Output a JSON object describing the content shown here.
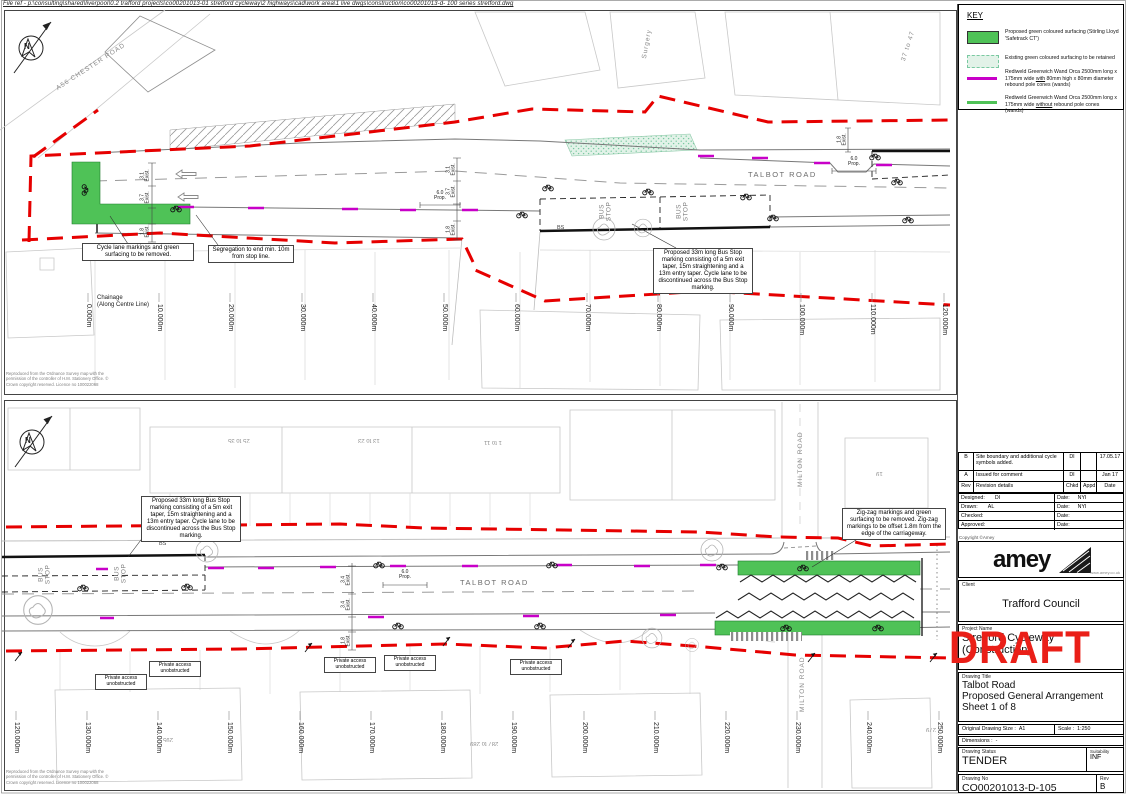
{
  "file_ref": "File ref - p:\\consulting\\shared\\liverpool\\0.2 trafford projects\\co00201013-01 stretford cycleway\\2 highways\\cad\\work area\\1 live dwgs\\construction\\co00201013-d- 100 series stretford.dwg",
  "os_copyright": "Reproduced from the Ordnance Survey map with the permission of the controller of H.M. Stationery Office. © Crown copyright reserved. Licence no 100022068",
  "north_label": "N",
  "draft_stamp": "DRAFT",
  "colors": {
    "boundary_red": "#e60000",
    "surface_green": "#4fc257",
    "wand_magenta": "#c800c8",
    "draft_red": "#ea1f18"
  },
  "key": {
    "title": "KEY",
    "item1": "Proposed green coloured surfacing (Stirling Lloyd 'Safetrack CT')",
    "item2": "Existing green coloured surfacing to be retained",
    "item3_pre": "Rediweld Greenwich Wand Orca 2500mm long x 175mm wide ",
    "item3_u": "with",
    "item3_post": " 80mm high x 80mm diameter rebound pole cones (wands)",
    "item4_pre": "Rediweld Greenwich Wand Orca 2500mm long x 175mm wide ",
    "item4_u": "without",
    "item4_post": " rebound pole cones (wands)"
  },
  "panel_top": {
    "road_label": "TALBOT ROAD",
    "side_road_label": "A56 CHESTER ROAD",
    "bus_stop_word1": "BUS",
    "bus_stop_word2": "STOP",
    "bs_label": "BS",
    "building_label_1": "37 to 47",
    "building_label_2": "Surgery",
    "ann_cycle_lane": "Cycle lane markings and green surfacing to be removed.",
    "ann_segregation": "Segregation to end min. 10m from stop line.",
    "ann_bus_stop": "Proposed 33m long Bus Stop marking consisting of a 5m exit taper, 15m straightening and a 13m entry taper. Cycle lane to be discontinued across the Bus Stop marking.",
    "chainage_title_line1": "Chainage",
    "chainage_title_line2": "(Along Centre Line)",
    "chainages": [
      "0.000m",
      "10.000m",
      "20.000m",
      "30.000m",
      "40.000m",
      "50.000m",
      "60.000m",
      "70.000m",
      "80.000m",
      "90.000m",
      "100.000m",
      "110.000m",
      "120.000m"
    ],
    "dims": [
      {
        "v": "3.1",
        "q": "Exist."
      },
      {
        "v": "3.7",
        "q": "Exist."
      },
      {
        "v": "1.8",
        "q": "Exist."
      },
      {
        "v": "6.0",
        "q": "Prop."
      },
      {
        "v": "6.0",
        "q": "Prop."
      },
      {
        "v": "1.8",
        "q": "Exist."
      }
    ]
  },
  "panel_bottom": {
    "road_label": "TALBOT ROAD",
    "side_road_label": "MILTON ROAD",
    "bus_stop_word1": "BUS",
    "bus_stop_word2": "STOP",
    "bs_label": "BS",
    "building_labels": [
      "25 to 35",
      "13 to 23",
      "1 to 11",
      "19",
      "295",
      "287 to 289",
      "279"
    ],
    "ann_bus_stop": "Proposed 33m long Bus Stop marking consisting of a 5m exit taper, 15m straightening and a 13m entry taper. Cycle lane to be discontinued across the Bus Stop marking.",
    "ann_zigzag": "Zig-zag markings and green surfacing to be removed.  Zig-zag markings to be offset 1.8m from the edge of the carriageway.",
    "private_access": "Private access unobstructed",
    "chainages": [
      "120.000m",
      "130.000m",
      "140.000m",
      "150.000m",
      "160.000m",
      "170.000m",
      "180.000m",
      "190.000m",
      "200.000m",
      "210.000m",
      "220.000m",
      "230.000m",
      "240.000m",
      "250.000m"
    ],
    "dims": [
      {
        "v": "3.4",
        "q": "Exist."
      },
      {
        "v": "3.4",
        "q": "Exist."
      },
      {
        "v": "1.8",
        "q": "Exist."
      },
      {
        "v": "6.0",
        "q": "Prop."
      }
    ]
  },
  "title_block": {
    "rev_rows": [
      {
        "rev": "B",
        "details": "Site boundary and additional cycle symbols added.",
        "chkd": "DI",
        "appd": "",
        "date": "17.05.17"
      },
      {
        "rev": "A",
        "details": "Issued for comment",
        "chkd": "DI",
        "appd": "",
        "date": "Jan 17"
      }
    ],
    "rev_headers": {
      "rev": "Rev",
      "details": "Revision details",
      "chkd": "Chkd",
      "appd": "Appd",
      "date": "Date"
    },
    "signoff": {
      "designed_label": "Designed:",
      "designed": "DI",
      "designed_date_label": "Date:",
      "designed_date": "NYI",
      "drawn_label": "Drawn:",
      "drawn": "AL",
      "drawn_date_label": "Date:",
      "drawn_date": "NYI",
      "checked_label": "Checked:",
      "checked": "",
      "checked_date_label": "Date:",
      "checked_date": "",
      "approved_label": "Approved:",
      "approved": "",
      "approved_date_label": "Date:",
      "approved_date": ""
    },
    "copyright": "Copyright ©Amey",
    "logo_text": "amey",
    "logo_url": "www.amey.co.uk",
    "client_label": "Client",
    "client": "Trafford Council",
    "project_label": "Project Name",
    "project_line1": "Stretford Cycleway",
    "project_line2": "(Construction)",
    "drawing_title_label": "Drawing Title",
    "title_line1": "Talbot Road",
    "title_line2": "Proposed General Arrangement",
    "title_line3": "Sheet 1 of 8",
    "size_label": "Original Drawing Size :",
    "size": "A1",
    "scale_label": "Scale :",
    "scale": "1:250",
    "dimensions_label": "Dimensions :",
    "dimensions": "-",
    "status_label": "Drawing Status",
    "status": "TENDER",
    "suitability_label": "Suitability",
    "suitability": "INF",
    "drawing_no_label": "Drawing No",
    "drawing_no": "CO00201013-D-105",
    "rev_label": "Rev",
    "rev": "B"
  }
}
